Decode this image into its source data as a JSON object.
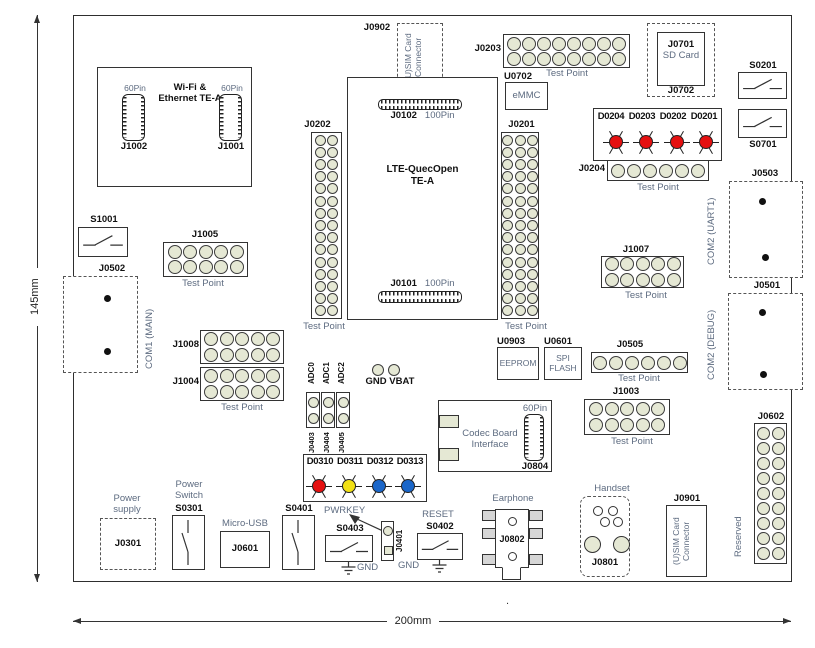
{
  "colors": {
    "pad_fill": "#e5e8d4",
    "led_red": "#e51010",
    "led_yellow": "#f2e114",
    "led_blue": "#1a66c9",
    "outline": "#333333",
    "caption_text": "#5d6b80"
  },
  "dimensions": {
    "height": "145mm",
    "width": "200mm",
    "stray_mark": "."
  },
  "labels": {
    "test_point": "Test Point",
    "pin60": "60Pin",
    "pin100": "100Pin",
    "gnd": "GND"
  },
  "wifi_module": {
    "title": "Wi-Fi &\nEthernet TE-A",
    "left_conn": "J1002",
    "right_conn": "J1001"
  },
  "usim_top": {
    "ref": "J0902",
    "text": "(U)SIM Card\nConnector"
  },
  "lte_module": {
    "title": "LTE-QuecOpen\nTE-A",
    "top_ref": "J0102",
    "bottom_ref": "J0101"
  },
  "emmc": {
    "ref": "U0702",
    "name": "eMMC"
  },
  "sd_card": {
    "ref": "J0701",
    "name": "SD Card",
    "ref2": "J0702"
  },
  "eeprom": {
    "ref": "U0903",
    "name": "EEPROM"
  },
  "spi_flash": {
    "ref": "U0601",
    "name": "SPI\nFLASH"
  },
  "switches": {
    "s0201": "S0201",
    "s0701": "S0701",
    "s1001": "S1001",
    "s0301": "S0301",
    "s0401": "S0401",
    "s0403": "S0403",
    "s0402": "S0402"
  },
  "headers": {
    "j0202": {
      "label": "J0202",
      "rows": 15,
      "cols": 2
    },
    "j0201": {
      "label": "J0201",
      "rows": 15,
      "cols": 3
    },
    "j0203": {
      "label": "J0203",
      "rows": 2,
      "cols": 8
    },
    "j0204": {
      "label": "J0204",
      "rows": 1,
      "cols": 6
    },
    "j1005": {
      "label": "J1005",
      "rows": 2,
      "cols": 5
    },
    "j1008": {
      "label": "J1008",
      "rows": 2,
      "cols": 5
    },
    "j1004": {
      "label": "J1004",
      "rows": 2,
      "cols": 5
    },
    "j1007": {
      "label": "J1007",
      "rows": 2,
      "cols": 5
    },
    "j0505": {
      "label": "J0505",
      "rows": 1,
      "cols": 6
    },
    "j1003": {
      "label": "J1003",
      "rows": 2,
      "cols": 5
    },
    "j0602": {
      "label": "J0602",
      "rows": 9,
      "cols": 2
    },
    "adc_header": {
      "rows": 2,
      "cols": 1
    },
    "gnd_vbat": {
      "rows": 1,
      "cols": 2
    }
  },
  "top_leds": {
    "items": [
      {
        "label": "D0204",
        "color": "#e51010"
      },
      {
        "label": "D0203",
        "color": "#e51010"
      },
      {
        "label": "D0202",
        "color": "#e51010"
      },
      {
        "label": "D0201",
        "color": "#e51010"
      }
    ]
  },
  "bottom_leds": {
    "items": [
      {
        "label": "D0310",
        "color": "#e51010"
      },
      {
        "label": "D0311",
        "color": "#f2e114"
      },
      {
        "label": "D0312",
        "color": "#1a66c9"
      },
      {
        "label": "D0313",
        "color": "#1a66c9"
      }
    ]
  },
  "com1": {
    "name": "COM1 (MAIN)",
    "ref": "J0502"
  },
  "com2_uart": {
    "name": "COM2 (UART1)",
    "ref": "J0503"
  },
  "com2_debug": {
    "name": "COM2 (DEBUG)",
    "ref": "J0501"
  },
  "adc": {
    "channels": [
      {
        "name": "ADC0",
        "ref": "J0403"
      },
      {
        "name": "ADC1",
        "ref": "J0404"
      },
      {
        "name": "ADC2",
        "ref": "J0405"
      }
    ]
  },
  "gnd_vbat_label": "GND VBAT",
  "codec": {
    "title": "Codec Board\nInterface",
    "ref": "J0804"
  },
  "power_supply": {
    "name": "Power\nsupply",
    "ref": "J0301"
  },
  "power_switch": {
    "name": "Power\nSwitch",
    "ref": "S0301"
  },
  "micro_usb": {
    "name": "Micro-USB",
    "ref": "J0601"
  },
  "pwrkey": {
    "name": "PWRKEY",
    "conn_ref": "J0401"
  },
  "reset": {
    "name": "RESET"
  },
  "earphone": {
    "name": "Earphone",
    "ref": "J0802"
  },
  "handset": {
    "name": "Handset",
    "ref": "J0801"
  },
  "usim_bottom": {
    "ref": "J0901",
    "text": "(U)SIM Card\nConnector"
  },
  "reserved": {
    "name": "Reserved"
  }
}
